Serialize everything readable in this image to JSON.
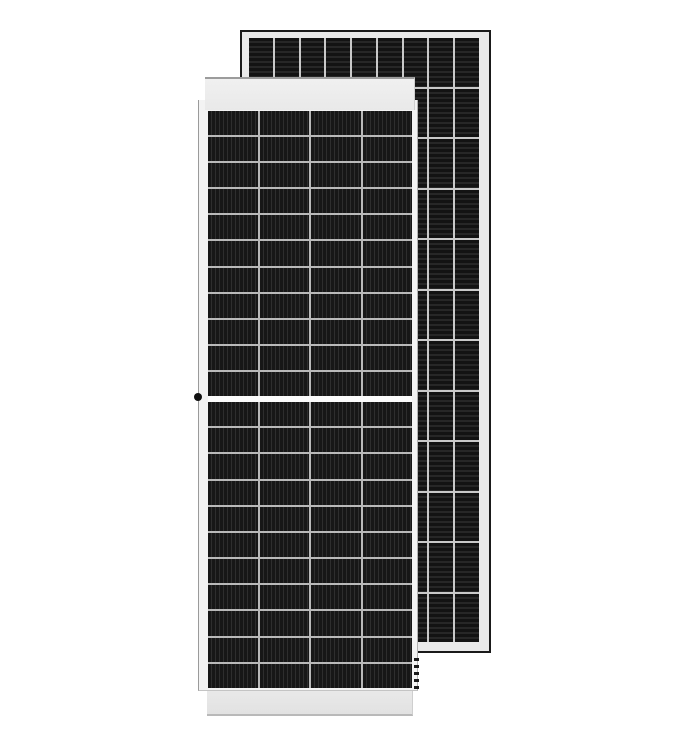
{
  "scene": {
    "type": "product-photo",
    "subject": "Two framed monocrystalline half-cut-cell solar photovoltaic panels, portrait orientation; front panel overlapping a second panel behind it to the upper right",
    "background_color": "#ffffff"
  },
  "colors": {
    "scene_bg": "#ffffff",
    "rear_frame": "#e9e9e9",
    "rear_border": "#1a1a1a",
    "rear_cell_base": "#131313",
    "rear_cell_stripe": "#272727",
    "rear_grid_line": "#c9c9c9",
    "front_frame": "#f3f3f3",
    "front_cap": "#e9e9e9",
    "front_cap_edge": "#9c9c9c",
    "front_cell_base": "#171717",
    "front_cell_stripe": "#2e2e2e",
    "front_grid_line": "#b9b9b9",
    "front_mid_gap": "#fbfbfb",
    "accent_dot": "#111111"
  },
  "front_panel": {
    "description": "front panel with white frame, top and bottom end caps, central horizontal busbar gap, grounding dot on left frame edge, mounting-hole dashes on lower right frame edge",
    "cell_stripe_direction": "vertical",
    "grid_upper": {
      "cols": 4,
      "rows": 11
    },
    "grid_lower": {
      "cols": 4,
      "rows": 11
    }
  },
  "rear_panel": {
    "description": "rear panel partially hidden behind front panel, dark thin outer border with silver inner frame",
    "cell_stripe_direction": "horizontal",
    "grid": {
      "cols": 9,
      "rows": 12
    }
  }
}
